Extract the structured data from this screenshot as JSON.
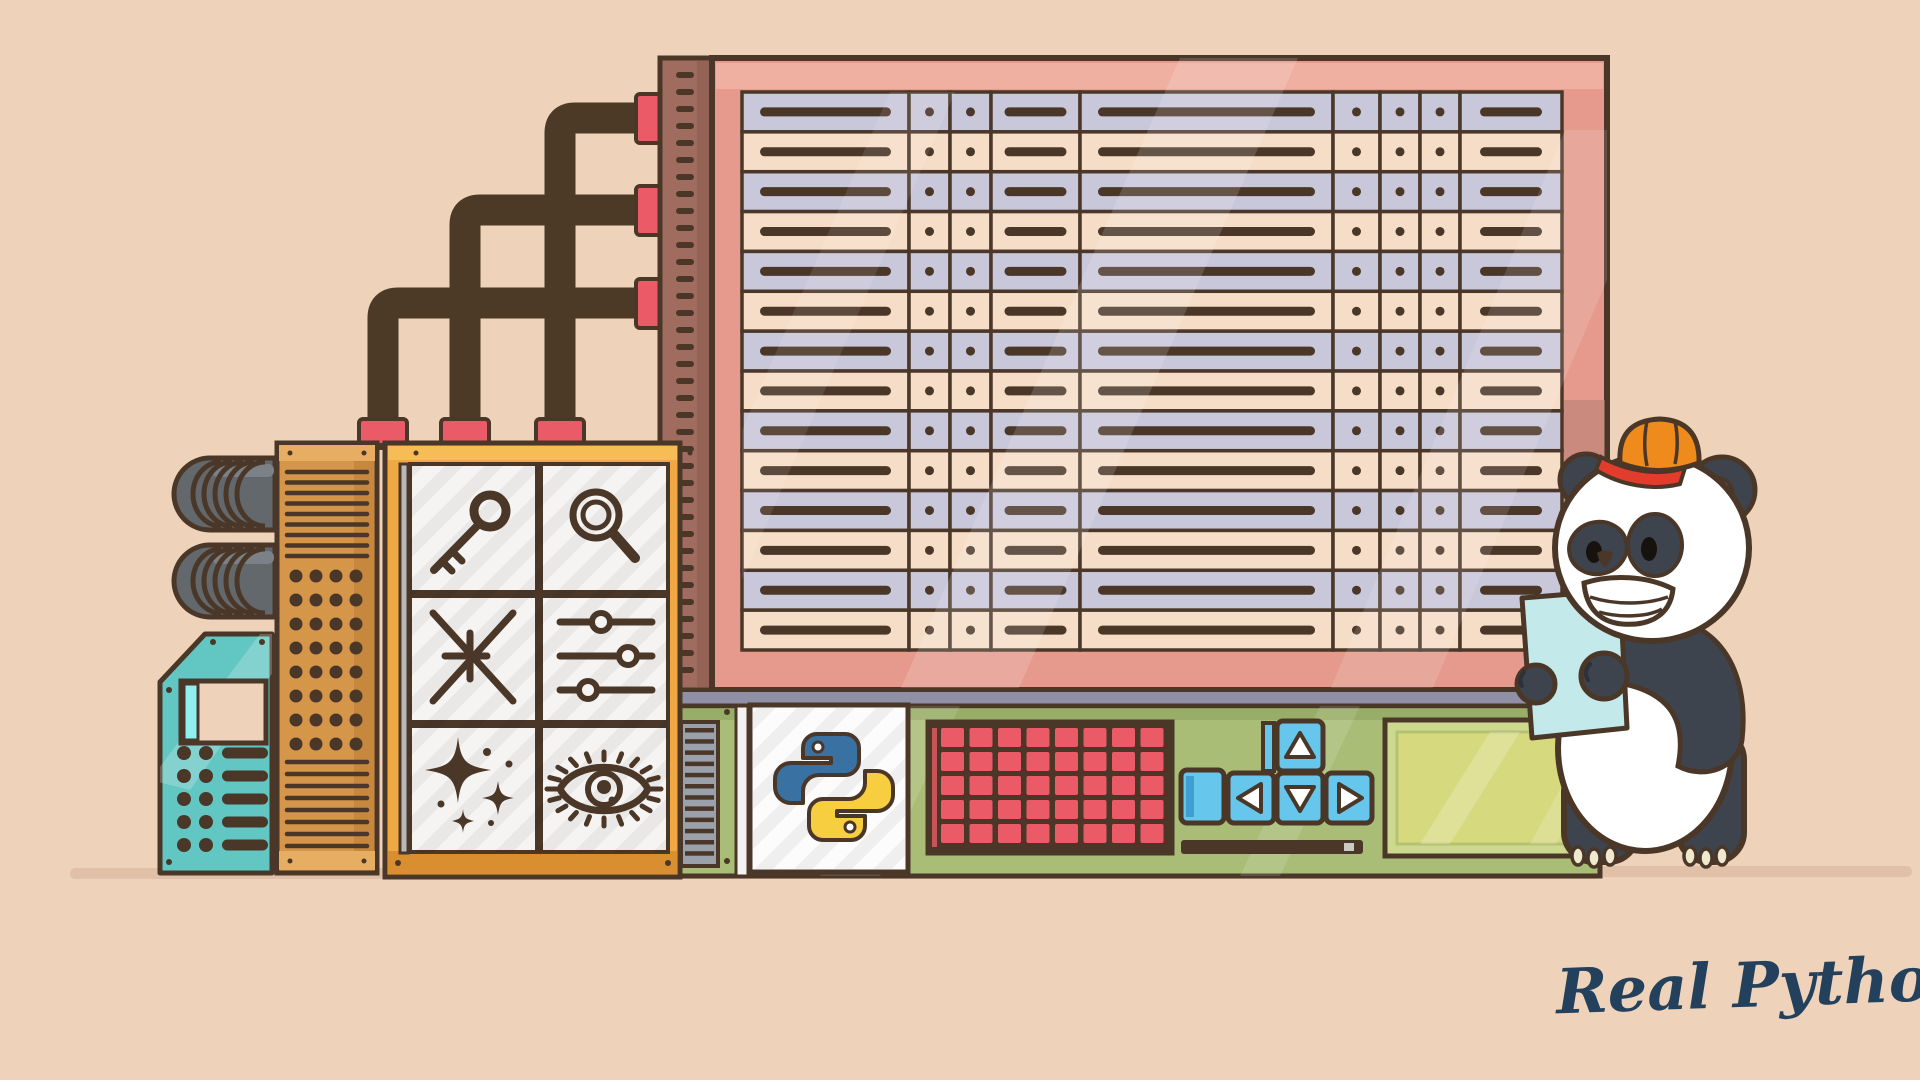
{
  "brand": {
    "logo_text": "Real Python"
  },
  "palette": {
    "bg": "#eed3ba",
    "ink": "#4a3728",
    "pipe": "#4c3a27",
    "spine": "#a06c5f",
    "pink": "#e59a8d",
    "pink_light": "#efb2a3",
    "pink_dark": "#b57f72",
    "row_lavender": "#c9c7da",
    "row_peach": "#f6ddc7",
    "red": "#ea5a67",
    "orange_cab": "#d6964a",
    "orange_cab_dark": "#bb7d34",
    "orange_panel": "#efa843",
    "orange_panel_dark": "#d98e2f",
    "tile": "#f5f4f2",
    "slate": "#8f8fa5",
    "green": "#a9bd77",
    "green_dark": "#8fa55f",
    "olive": "#d6d97d",
    "chalk_frame": "#ccd98e",
    "teal": "#62c6c3",
    "teal_bright": "#8ff0ef",
    "blue_key": "#66c6ec",
    "blue_key_dark": "#3f9fd0",
    "gray_vent": "#9aa1ab",
    "bellows": "#63686d",
    "bellows_light": "#7c8187",
    "panda_dark": "#3e444e",
    "panda_white": "#ffffff",
    "ear_pink": "#e8a0ab",
    "cap_orange": "#ef8b1c",
    "cap_red": "#e23c2c",
    "paper": "#c3e9ea",
    "cream": "#efe9d0",
    "brand": "#23405c",
    "shadow": "#dcbda3",
    "python_blue": "#3a71a3",
    "python_yellow": "#f7ce3f",
    "white_strip": "#f2f2f2",
    "ruler_notch": "#c9cbc4"
  },
  "board": {
    "row_count": 14,
    "columns": [
      "bar-long",
      "dot",
      "dot",
      "bar-short",
      "bar-long",
      "dot",
      "dot",
      "dot",
      "bar-short"
    ]
  },
  "keypad_grid": {
    "rows": 5,
    "cols": 8
  },
  "dpad": {
    "keys": [
      "up",
      "left",
      "down",
      "right"
    ]
  },
  "icon_panel": {
    "icons": [
      "key",
      "magnifier",
      "compress",
      "sliders",
      "sparkles",
      "eye"
    ]
  }
}
